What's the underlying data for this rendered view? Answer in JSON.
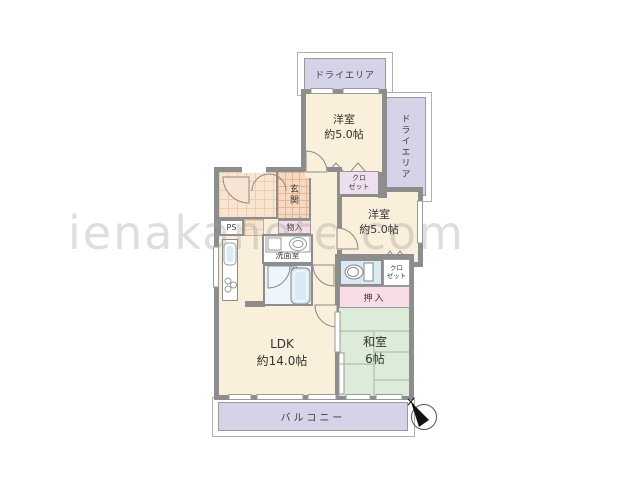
{
  "watermark": "ienakanote.com",
  "colors": {
    "wall": "#8d8d8d",
    "room_cream": "#f9efda",
    "lavender": "#d6d3e8",
    "pink": "#f8dce8",
    "tatami_green": "#dcecd9",
    "water_blue": "#d9eaf4",
    "tile_orange": "#f6d9c2",
    "outline_gray": "#b0b0b0"
  },
  "rooms": {
    "dry_area_top": {
      "label": "ドライエリア"
    },
    "dry_area_right": {
      "label": "ドライエリア"
    },
    "bedroom_top": {
      "label": "洋室\n約5.0帖"
    },
    "bedroom_mid": {
      "label": "洋室\n約5.0帖"
    },
    "closet_top": {
      "label": "クロ\nゼット"
    },
    "closet_right": {
      "label": "クロ\nゼット"
    },
    "entrance": {
      "label": "玄関"
    },
    "pipe_space": {
      "label": "PS"
    },
    "storage": {
      "label": "物入"
    },
    "washroom": {
      "label": "洗面室"
    },
    "bathroom": {
      "label": "浴室"
    },
    "oshiire": {
      "label": "押入"
    },
    "japanese_room": {
      "label": "和室\n6帖"
    },
    "ldk": {
      "label": "LDK\n約14.0帖"
    },
    "balcony": {
      "label": "バルコニー"
    }
  },
  "icons": {
    "compass": "compass-north-icon",
    "toilet": "toilet-icon",
    "bathtub": "bathtub-icon",
    "kitchen_sink": "kitchen-sink-icon",
    "stove": "stove-icon",
    "wash_basin": "wash-basin-icon",
    "washing_machine": "washing-machine-icon"
  }
}
